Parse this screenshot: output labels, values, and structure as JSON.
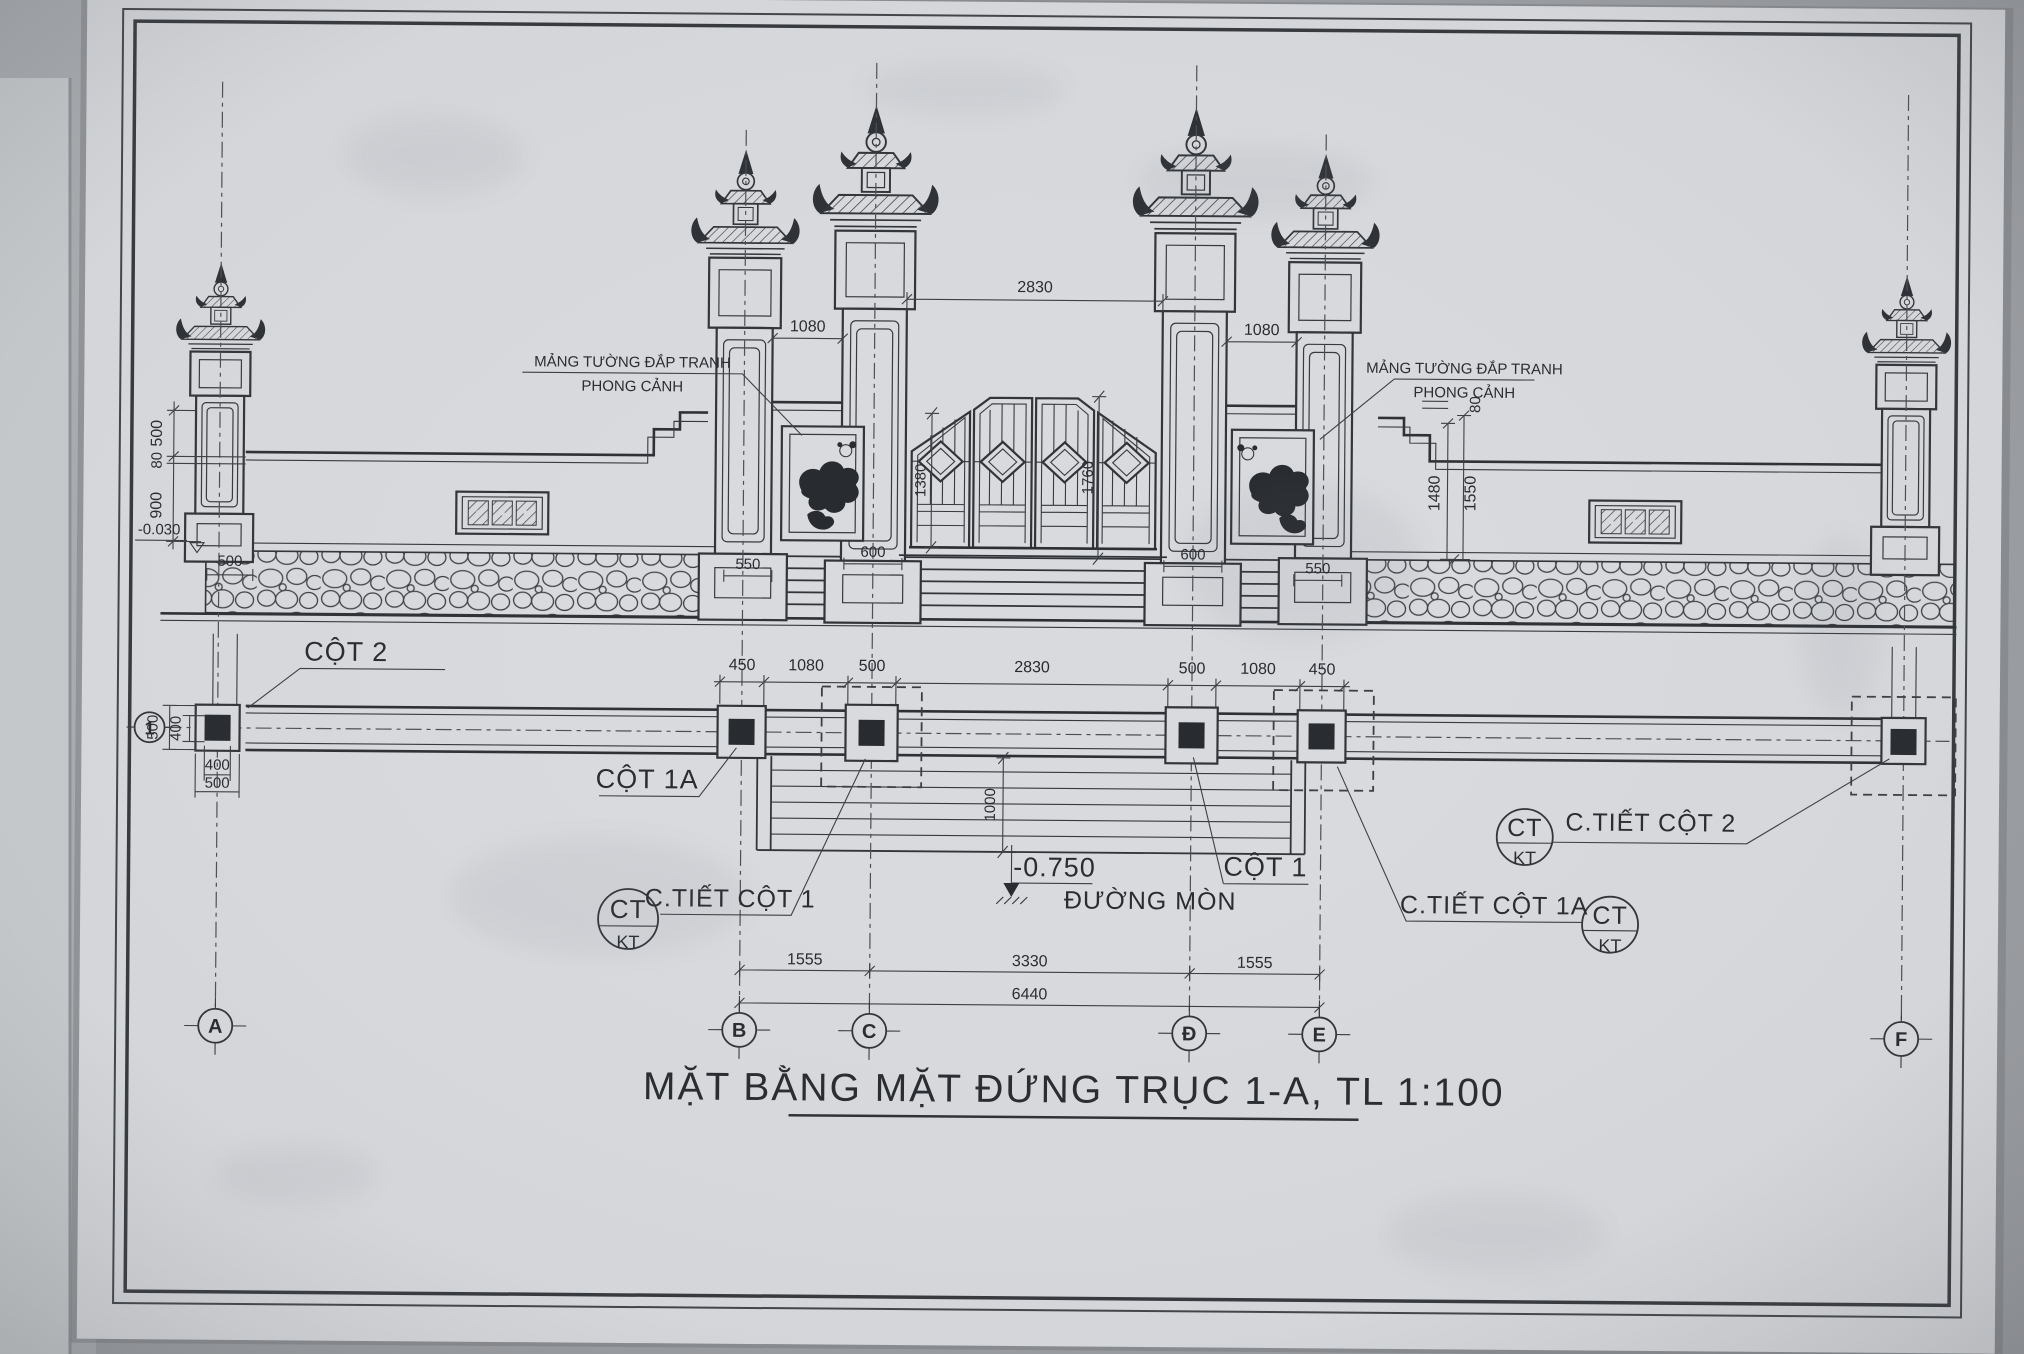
{
  "title": {
    "text": "MẶT BẰNG MẶT ĐỨNG TRỤC 1-A, TL 1:100"
  },
  "grid": {
    "axis_1": "1",
    "axis_a": "A",
    "axis_b": "B",
    "axis_c": "C",
    "axis_d": "Đ",
    "axis_e": "E",
    "axis_f": "F"
  },
  "elevation": {
    "relief_label_line1": "MẢNG TƯỜNG ĐẮP TRANH",
    "relief_label_line2": "PHONG CẢNH",
    "dim_bay_left": "1080",
    "dim_gate_span": "2830",
    "dim_bay_right": "1080",
    "dim_left_500": "500",
    "dim_left_80": "80",
    "dim_left_900": "900",
    "level_wall_base": "-0.030",
    "dim_base_500": "500",
    "dim_right_80": "80",
    "dim_right_1480": "1480",
    "dim_right_1550": "1550",
    "dim_base_550_left": "550",
    "dim_base_600_left": "600",
    "dim_base_600_right": "600",
    "dim_base_550_right": "550",
    "dim_gate_1380": "1380",
    "dim_gate_1760": "1760"
  },
  "plan": {
    "dims_top": [
      "450",
      "1080",
      "500",
      "2830",
      "500",
      "1080",
      "450"
    ],
    "dim_col_500_v": "500",
    "dim_col_400_v": "400",
    "dim_col_400_h": "400",
    "dim_col_500_h": "500",
    "dim_path_width": "1000",
    "dim_span_left": "1555",
    "dim_span_mid": "3330",
    "dim_span_right": "1555",
    "dim_total": "6440",
    "label_cot_2": "CỘT 2",
    "label_cot_1a": "CỘT 1A",
    "label_cot_1": "CỘT 1",
    "label_path": "ĐƯỜNG MÒN",
    "level_path": "-0.750"
  },
  "callouts": {
    "symbol_top": "CT",
    "symbol_bottom": "KT",
    "detail_cot_1": "C.TIẾT CỘT 1",
    "detail_cot_1a": "C.TIẾT CỘT 1A",
    "detail_cot_2": "C.TIẾT CỘT 2"
  }
}
